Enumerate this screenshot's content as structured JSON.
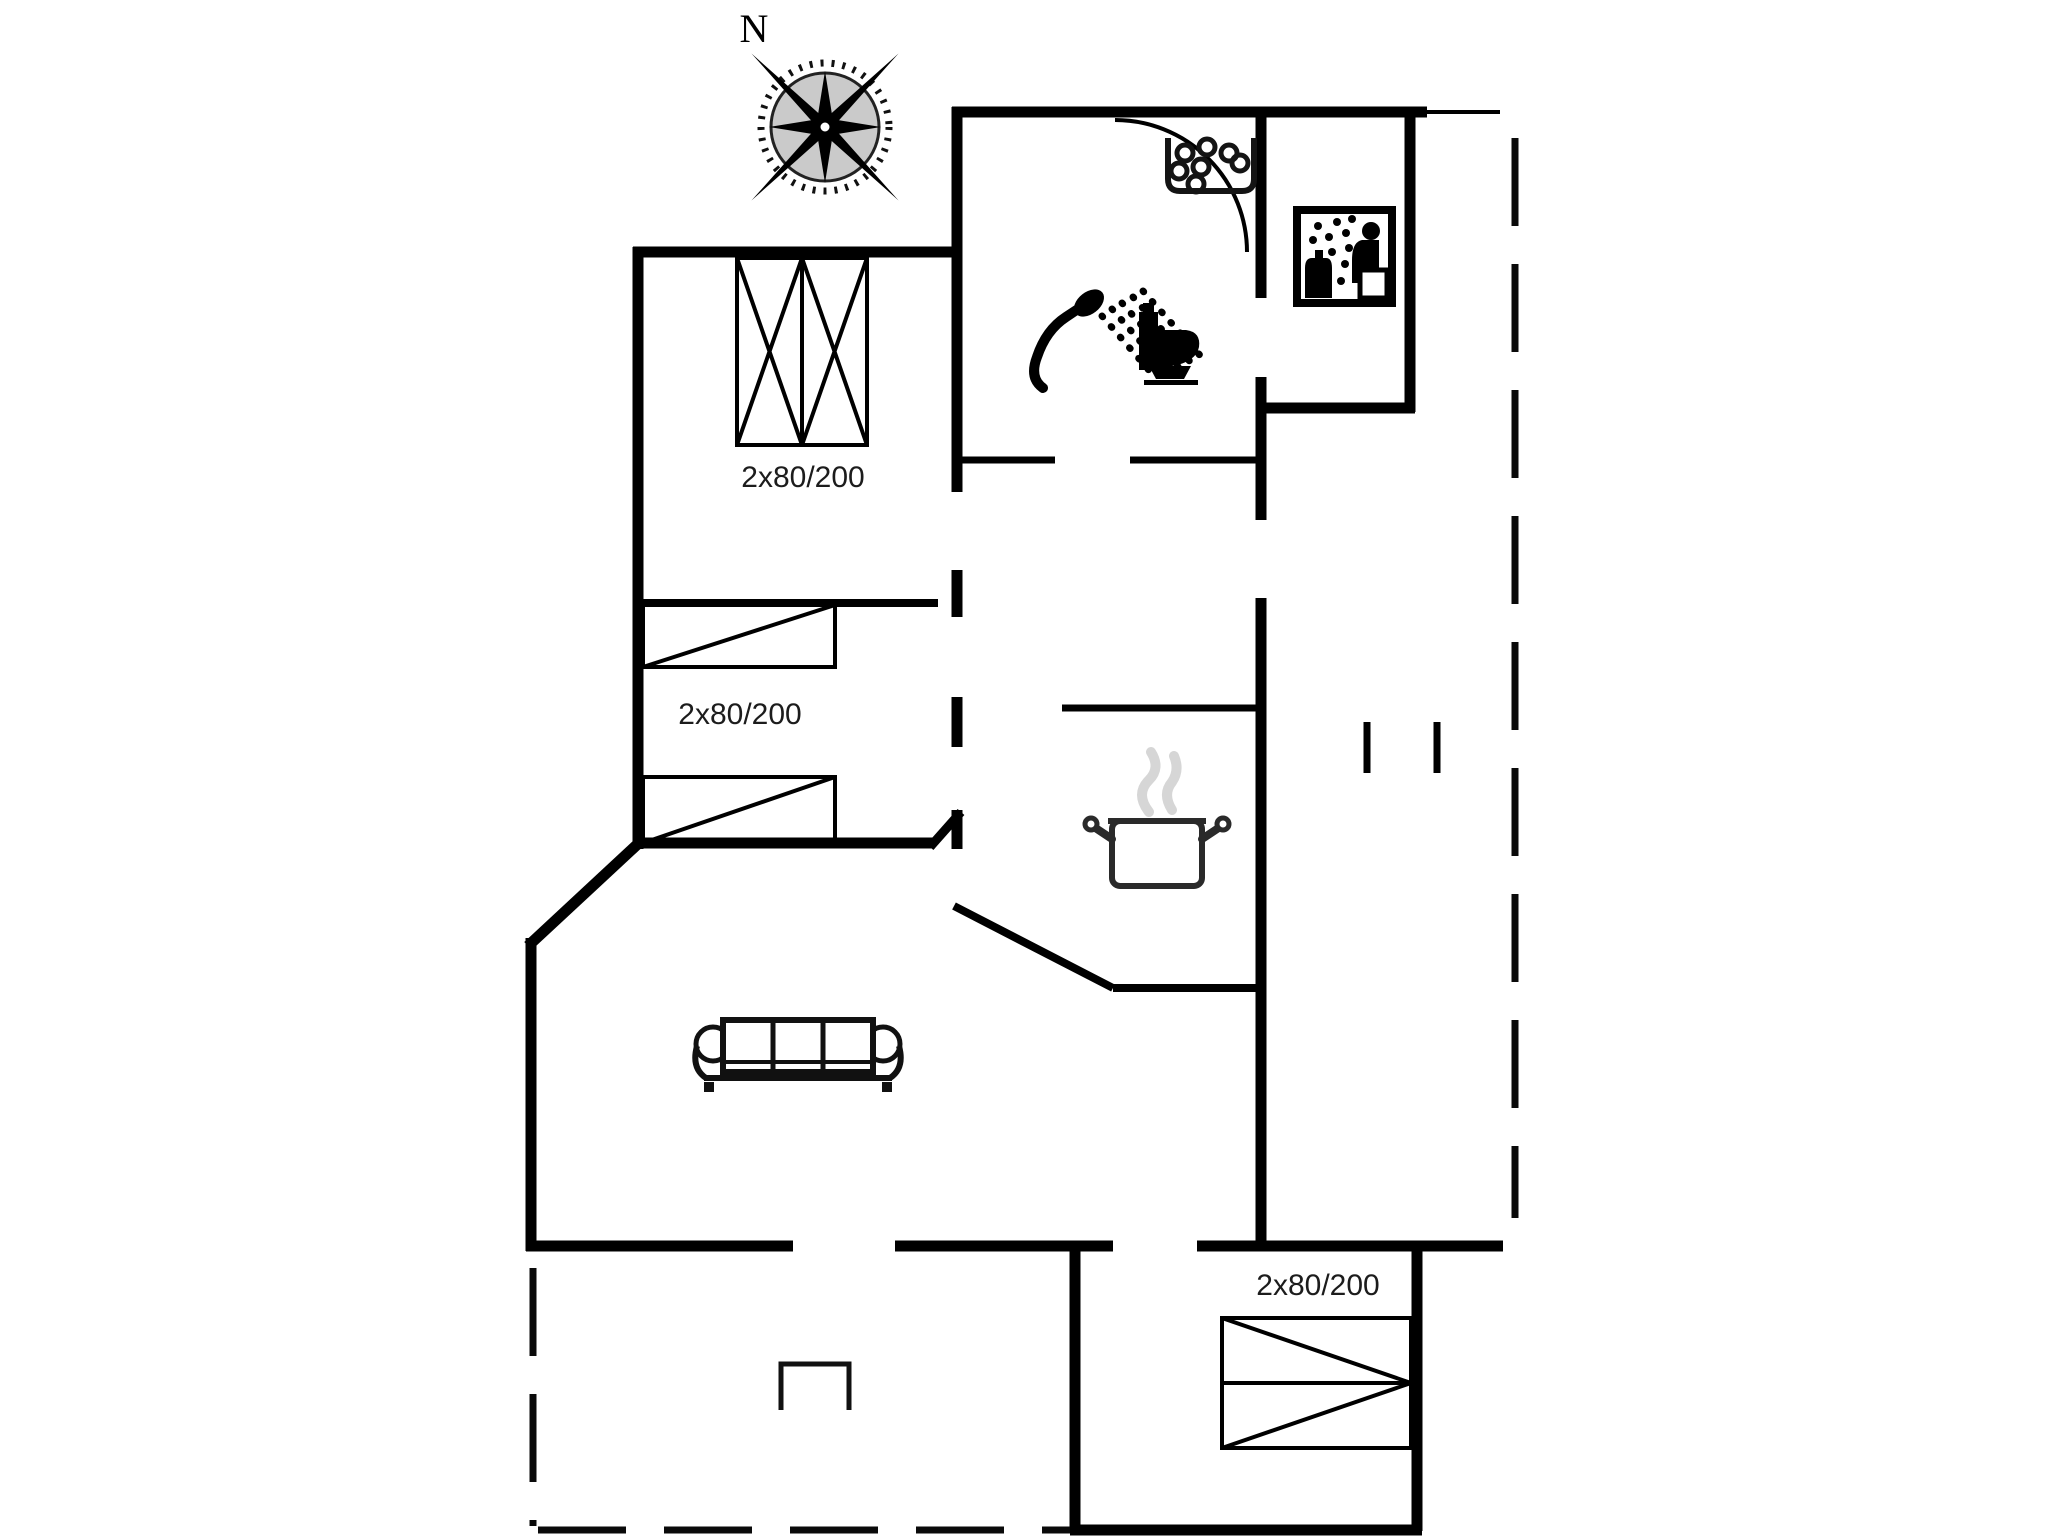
{
  "compass": {
    "north_label": "N"
  },
  "labels": {
    "bedroom_top_bed": "2x80/200",
    "bedroom_middle_bed": "2x80/200",
    "bedroom_bottom_bed": "2x80/200"
  },
  "icons": {
    "compass": "compass-rose",
    "whirlpool": "whirlpool-tub",
    "sauna": "sauna-pictogram",
    "shower": "shower-handset",
    "toilet": "toilet",
    "pot": "steaming-cooking-pot",
    "sofa": "three-seat-sofa",
    "grill": "grill",
    "beds": "bed-symbols"
  },
  "colors": {
    "line": "#000000",
    "background": "#ffffff",
    "steam": "#d6d6d6",
    "compass_disc": "#9f9f9f"
  }
}
